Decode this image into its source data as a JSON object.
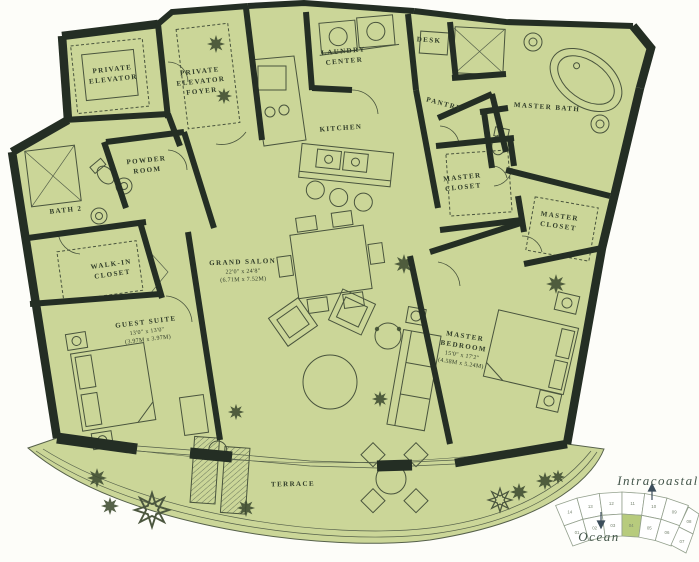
{
  "plan": {
    "rooms": [
      {
        "id": "private-elevator",
        "name": "PRIVATE\nELEVATOR"
      },
      {
        "id": "private-elevator-foyer",
        "name": "PRIVATE\nELEVATOR\nFOYER"
      },
      {
        "id": "laundry-center",
        "name": "LAUNDRY\nCENTER"
      },
      {
        "id": "desk",
        "name": "DESK"
      },
      {
        "id": "kitchen",
        "name": "KITCHEN"
      },
      {
        "id": "pantry",
        "name": "PANTRY"
      },
      {
        "id": "master-bath",
        "name": "MASTER BATH"
      },
      {
        "id": "master-closet-a",
        "name": "MASTER\nCLOSET"
      },
      {
        "id": "master-closet-b",
        "name": "MASTER\nCLOSET"
      },
      {
        "id": "powder-room",
        "name": "POWDER\nROOM"
      },
      {
        "id": "bath-2",
        "name": "BATH 2"
      },
      {
        "id": "walk-in-closet",
        "name": "WALK-IN\nCLOSET"
      },
      {
        "id": "grand-salon",
        "name": "GRAND SALON",
        "dims_ft": "22'0\" x 24'8\"",
        "dims_m": "(6.71M x 7.52M)"
      },
      {
        "id": "guest-suite",
        "name": "GUEST SUITE",
        "dims_ft": "13'0\" x 13'0\"",
        "dims_m": "(3.97M x 3.97M)"
      },
      {
        "id": "master-bedroom",
        "name": "MASTER\nBEDROOM",
        "dims_ft": "15'0\" x 17'2\"",
        "dims_m": "(4.58M x 5.24M)"
      },
      {
        "id": "terrace",
        "name": "TERRACE"
      }
    ]
  },
  "keyplan": {
    "waterside_top": "Intracoastal",
    "waterside_bottom": "Ocean",
    "highlighted_unit": "04",
    "units_top_row": [
      "14",
      "13",
      "12",
      "11",
      "10",
      "09"
    ],
    "units_bottom_row": [
      "01",
      "02",
      "03",
      "04",
      "05",
      "06"
    ],
    "units_bend": [
      "08",
      "07"
    ]
  },
  "colors": {
    "floor": "#cbd698",
    "wall": "#242e24",
    "line": "#49543d",
    "highlight": "#b7cb7d"
  }
}
